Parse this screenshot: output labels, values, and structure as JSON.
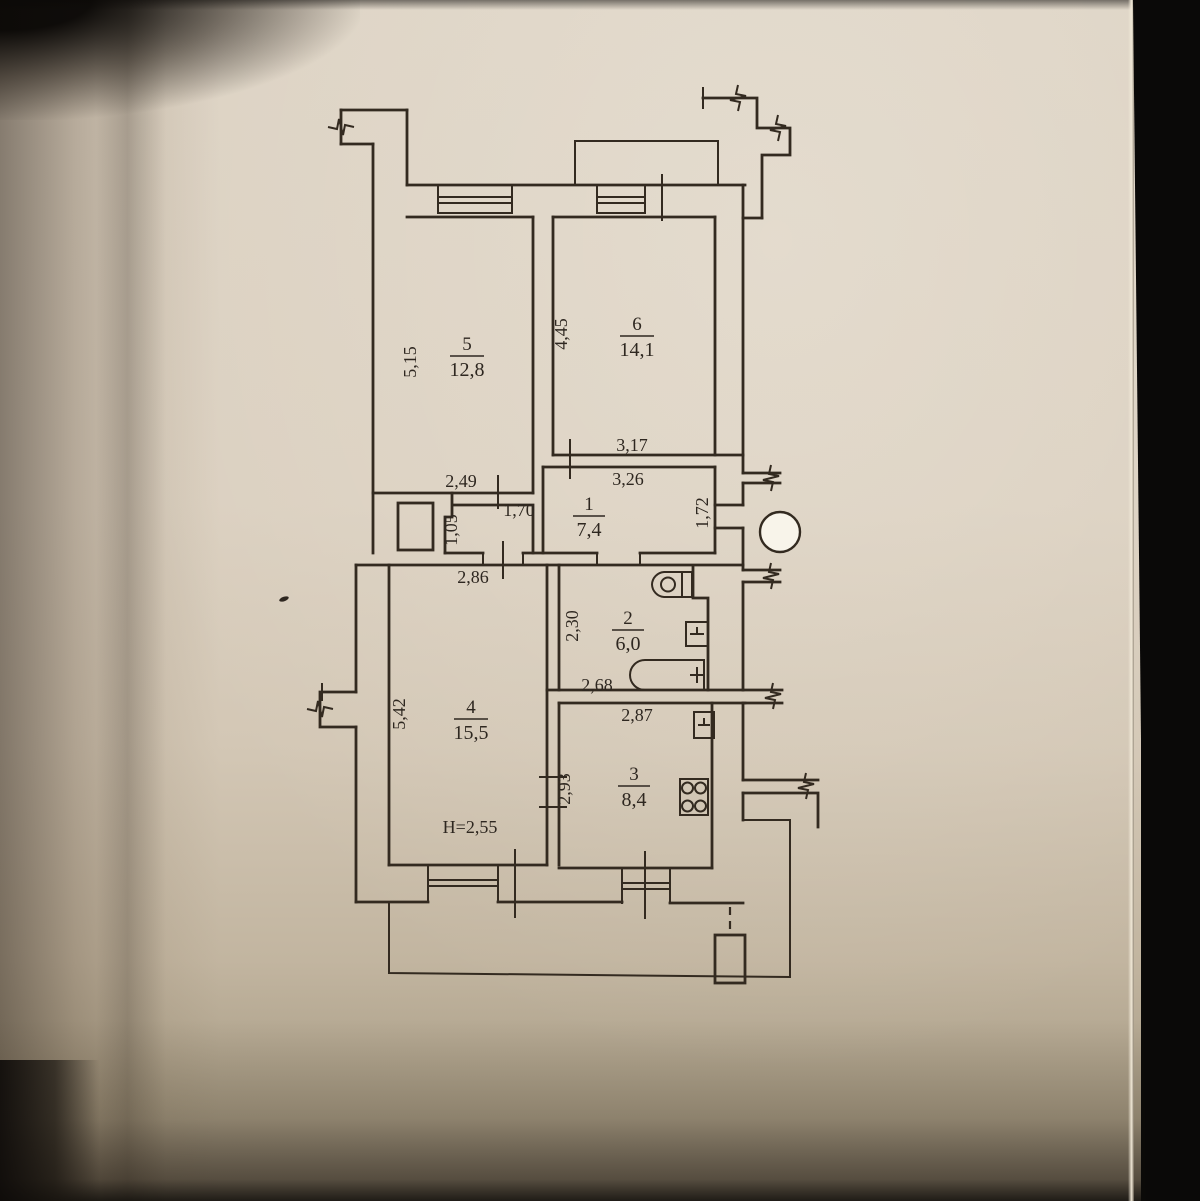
{
  "photo": {
    "colors": {
      "paper": "#d9cfc0",
      "ink": "#332a20",
      "background": "#0b0a08",
      "hole_punch": "#f8f4ea"
    }
  },
  "floor_plan": {
    "rooms": {
      "r1": {
        "num": "1",
        "area": "7,4"
      },
      "r2": {
        "num": "2",
        "area": "6,0"
      },
      "r3": {
        "num": "3",
        "area": "8,4"
      },
      "r4": {
        "num": "4",
        "area": "15,5"
      },
      "r5": {
        "num": "5",
        "area": "12,8"
      },
      "r6": {
        "num": "6",
        "area": "14,1"
      }
    },
    "dims": {
      "d515": "5,15",
      "d445": "4,45",
      "d317": "3,17",
      "d326": "3,26",
      "d249": "2,49",
      "d170": "1,70",
      "d105": "1,05",
      "d172": "1,72",
      "d286": "2,86",
      "d230": "2,30",
      "d268": "2,68",
      "d542": "5,42",
      "d287": "2,87",
      "d293": "2,93",
      "height": "H=2,55"
    }
  }
}
